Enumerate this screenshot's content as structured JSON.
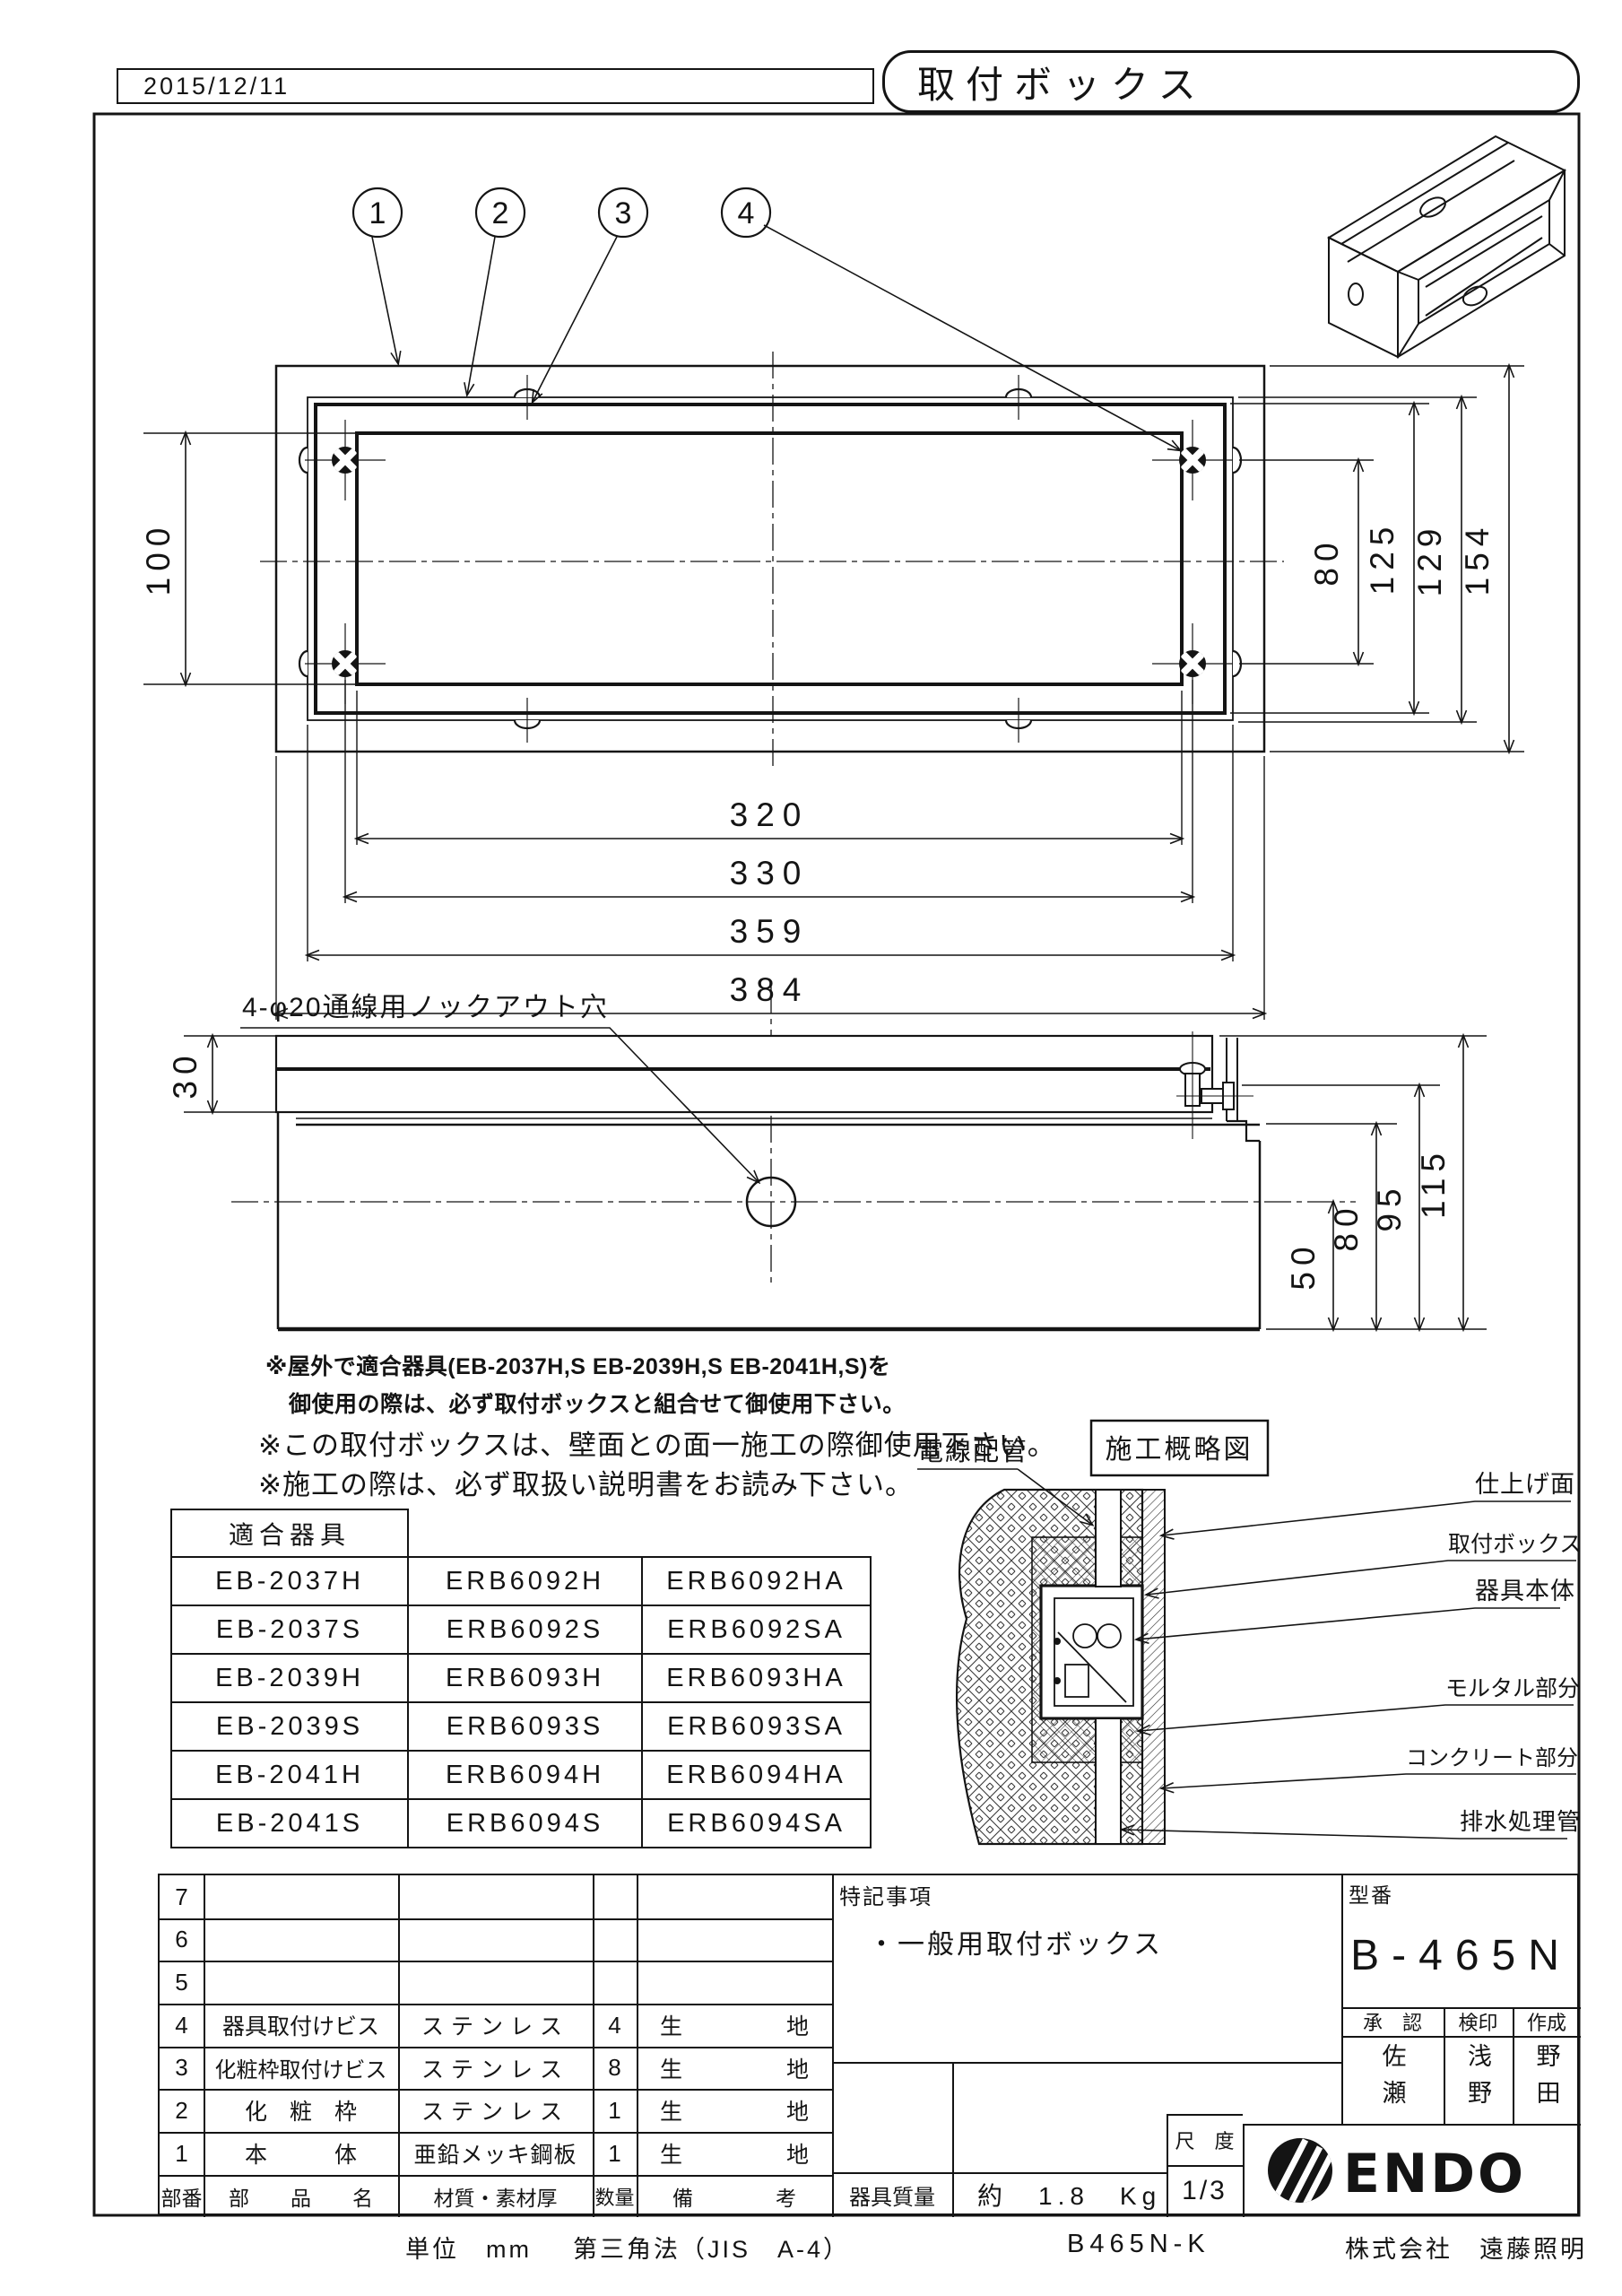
{
  "header": {
    "date": "2015/12/11",
    "title": "取付ボックス"
  },
  "callouts": [
    "1",
    "2",
    "3",
    "4"
  ],
  "top_view": {
    "dim_left": "100",
    "dims_right": [
      "80",
      "125",
      "129",
      "154"
    ],
    "dims_bottom": [
      "320",
      "330",
      "359",
      "384"
    ]
  },
  "side_view": {
    "knockout_label": "4-φ20通線用ノックアウト穴",
    "dim_left": "30",
    "dims_right": [
      "50",
      "80",
      "95",
      "115"
    ]
  },
  "notes": {
    "line1": "※屋外で適合器具(EB-2037H,S EB-2039H,S EB-2041H,S)を",
    "line2": "御使用の際は、必ず取付ボックスと組合せて御使用下さい。",
    "line3": "※この取付ボックスは、壁面との面一施工の際御使用下さい。",
    "line4": "※施工の際は、必ず取扱い説明書をお読み下さい。"
  },
  "compat_table": {
    "header": "適合器具",
    "rows": [
      [
        "EB-2037H",
        "ERB6092H",
        "ERB6092HA"
      ],
      [
        "EB-2037S",
        "ERB6092S",
        "ERB6092SA"
      ],
      [
        "EB-2039H",
        "ERB6093H",
        "ERB6093HA"
      ],
      [
        "EB-2039S",
        "ERB6093S",
        "ERB6093SA"
      ],
      [
        "EB-2041H",
        "ERB6094H",
        "ERB6094HA"
      ],
      [
        "EB-2041S",
        "ERB6094S",
        "ERB6094SA"
      ]
    ]
  },
  "section_diagram": {
    "title": "施工概略図",
    "label_wiring": "電線配管",
    "label_finish": "仕上げ面",
    "label_box": "取付ボックス",
    "label_fixture": "器具本体",
    "label_mortar": "モルタル部分",
    "label_concrete": "コンクリート部分",
    "label_drain": "排水処理管"
  },
  "parts_table": {
    "header": {
      "no": "部番",
      "name": "部　　品　　名",
      "material": "材質・素材厚",
      "qty": "数量",
      "remark_l": "備",
      "remark_r": "考"
    },
    "rows": [
      {
        "no": "7",
        "name": "",
        "material": "",
        "qty": "",
        "remark_l": "",
        "remark_r": ""
      },
      {
        "no": "6",
        "name": "",
        "material": "",
        "qty": "",
        "remark_l": "",
        "remark_r": ""
      },
      {
        "no": "5",
        "name": "",
        "material": "",
        "qty": "",
        "remark_l": "",
        "remark_r": ""
      },
      {
        "no": "4",
        "name": "器具取付けビス",
        "material": "ステンレス",
        "qty": "4",
        "remark_l": "生",
        "remark_r": "地"
      },
      {
        "no": "3",
        "name": "化粧枠取付けビス",
        "material": "ステンレス",
        "qty": "8",
        "remark_l": "生",
        "remark_r": "地"
      },
      {
        "no": "2",
        "name": "化　粧　枠",
        "material": "ステンレス",
        "qty": "1",
        "remark_l": "生",
        "remark_r": "地"
      },
      {
        "no": "1",
        "name": "本　　　体",
        "material": "亜鉛メッキ鋼板",
        "qty": "1",
        "remark_l": "生",
        "remark_r": "地"
      }
    ]
  },
  "title_block": {
    "notes_label": "特記事項",
    "note": "・一般用取付ボックス",
    "model_label": "型番",
    "model": "B-465N",
    "approve_label": "承　認",
    "check_label": "検印",
    "create_label": "作成",
    "approver": "佐瀬",
    "checker": "浅野",
    "creator": "野田",
    "scale_label": "尺　度",
    "scale": "1/3",
    "mass_label": "器具質量",
    "mass": "約　1.8　Kg",
    "logo": "ENDO"
  },
  "footer": {
    "units": "単位　mm",
    "projection": "第三角法（JIS　A-4）",
    "code": "B465N-K",
    "company": "株式会社　遠藤照明"
  }
}
